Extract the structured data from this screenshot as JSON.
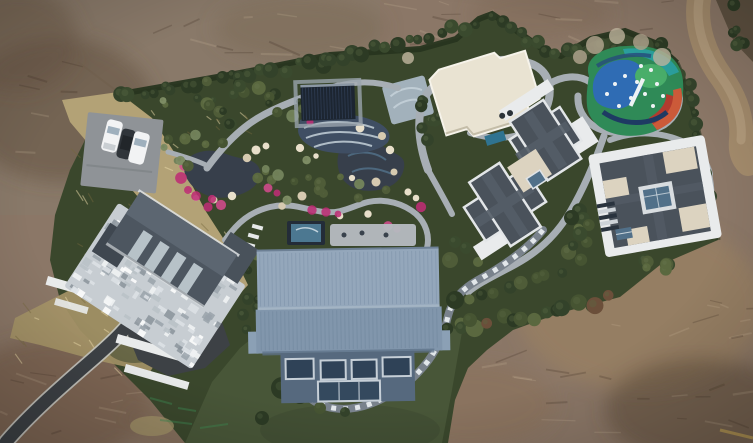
{
  "meta": {
    "title": "Aerial drone photograph of a private estate",
    "kind": "top-down aerial photo",
    "width_px": 753,
    "height_px": 443
  },
  "scene": {
    "summary": "Top-down drone view of a landscaped private estate: a large blue-metal-roof hall, a stone-courtyard house, two gray-roof villas, an ornamental rock garden with ponds and winding stone paths, a dark ribbed pool canopy, a cream flat-roof pavilion, a brightly painted playground, a parking pad with three cars, a curving asphalt driveway and a dirt track, all ringed by hedges and graded bare earth.",
    "labels": {
      "main_hall": "blue metal-roof hall",
      "west_house": "stone-courtyard house",
      "middle_villa": "cross-plan gray-roof villa",
      "east_villa": "square gray-roof villa",
      "pavilion": "cream flat-roof pavilion",
      "pool_canopy": "dark ribbed pool canopy",
      "mosaic_pool": "wave-mosaic pool",
      "terrace_pool": "small terrace pool",
      "playground": "painted playground",
      "garden": "rock garden with ponds",
      "parking": "parking pad",
      "cars": "three parked cars",
      "driveway": "asphalt driveway",
      "dirt_road": "dirt track",
      "lawn": "lawn",
      "hedge": "boundary hedge",
      "dirt": "graded earth"
    },
    "counts": {
      "cars": 3,
      "villas": 3,
      "ponds": 2,
      "pools": 2
    }
  },
  "palette": {
    "dirt": "#8b7767",
    "dirtTopLeft": "#897c6c",
    "dirtDark": "#5f4d3c",
    "dirtLight": "#a0855f",
    "dirtRoad": "#a28a6b",
    "dirtRoadLight": "#b7a080",
    "asphalt": "#3d4145",
    "roadEdge": "#c6c8c2",
    "propertyGreen": "#3a472c",
    "hedge": "#27351f",
    "lawn": "#485638",
    "goldenGrass": "#b3a276",
    "goldenGrass2": "#a59467",
    "scrubOlive": "#6b6a47",
    "path": "#a7aeb4",
    "stonePath": "#79828c",
    "stoneDash": "#e8ecef",
    "pond": "#373f4b",
    "pondStreak": "#5c83a0",
    "poolTile": "#3f4e63",
    "poolWave": "#cdd9e0",
    "poolDeck": "#aebccb",
    "canopy": "#1c2531",
    "canopyRib": "#2e3c52",
    "terracePoolFrame": "#232c38",
    "terracePoolWater": "#4c7891",
    "terracePaver": "#b6bcc1",
    "roofBlueTop": "#94a7bb",
    "roofBlueBottom": "#8196ac",
    "roofBlueEave": "#6d8095",
    "facadeBlue": "#56697e",
    "windowGlass": "#2f4257",
    "windowFrame": "#c6cfd7",
    "roofSlate": "#4a525b",
    "roofSlateLight": "#555e68",
    "houseRoof": "#4d5660",
    "houseRoofLight": "#5c6671",
    "skylight": "#c3ced4",
    "whiteTrim": "#e9ebec",
    "creamRoof": "#e9e3d2",
    "creamRoof2": "#dcd3c0",
    "courtyard": "#c7cdd2",
    "wallWhite": "#e9ebeb",
    "parkingPad": "#8f9397",
    "carWhite": "#f2f3f4",
    "carDark": "#30353a",
    "glassBlue": "#517089",
    "tealDeck": "#2f7390",
    "flower": "#bd2e74",
    "flowerLight": "#d14b8c",
    "rock": "#d6cab0",
    "rockLight": "#e8dfca",
    "playGreen": "#2f8a57",
    "playGreenLight": "#49ae6a",
    "playBlue": "#2f6cb4",
    "playTeal": "#2ba09e",
    "playOrange": "#cc5a39",
    "playRed": "#b23b2e",
    "playNavy": "#1e3a63",
    "playWhite": "#eef2f4",
    "treeDark": "#2c3a24",
    "treeOlive": "#4f5c38",
    "treeSage": "#71815a",
    "treePale": "#b4a791",
    "treeRust": "#6b4f3a",
    "paintMark": "#3f8a52",
    "yellowMark": "#c9a852"
  }
}
